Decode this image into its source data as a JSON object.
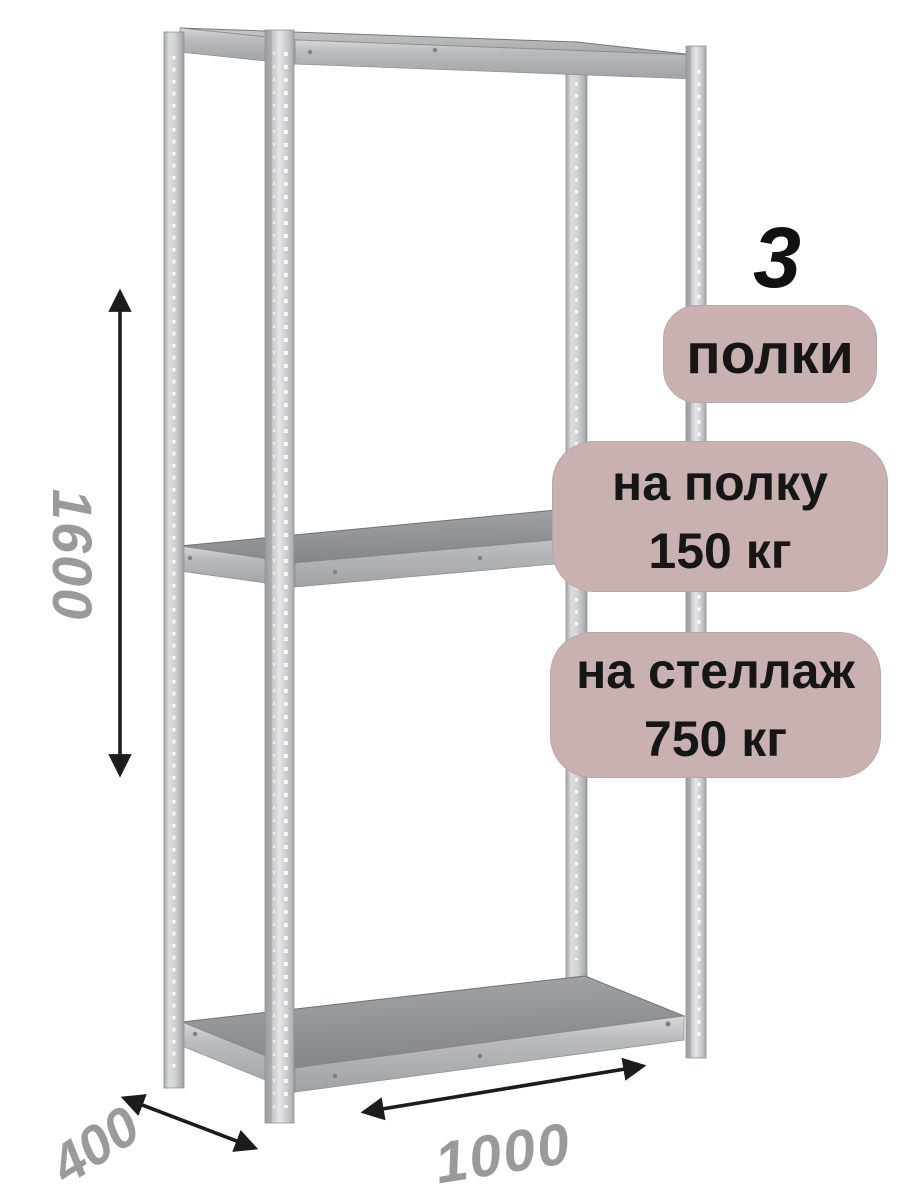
{
  "badges": {
    "shelf_count": {
      "value": "3",
      "label": "полки"
    },
    "per_shelf": {
      "label": "на полку",
      "value": "150 кг"
    },
    "per_rack": {
      "label": "на стеллаж",
      "value": "750 кг"
    }
  },
  "dimensions_mm": {
    "height": "1600",
    "depth": "400",
    "width": "1000"
  },
  "colors": {
    "background": "#ffffff",
    "badge_background": "#c9b1b2",
    "badge_text": "#161616",
    "count_text": "#111111",
    "dimension_text": "#9a9a9a",
    "arrow": "#1c1c1c",
    "metal_post": "#c6c9cb",
    "shelf_top": "#8c9092",
    "shelf_edge": "#b5b8ba"
  },
  "icons": {
    "height_arrow": "double-headed-vertical-arrow",
    "depth_arrow": "double-headed-diagonal-arrow",
    "width_arrow": "double-headed-diagonal-arrow"
  }
}
